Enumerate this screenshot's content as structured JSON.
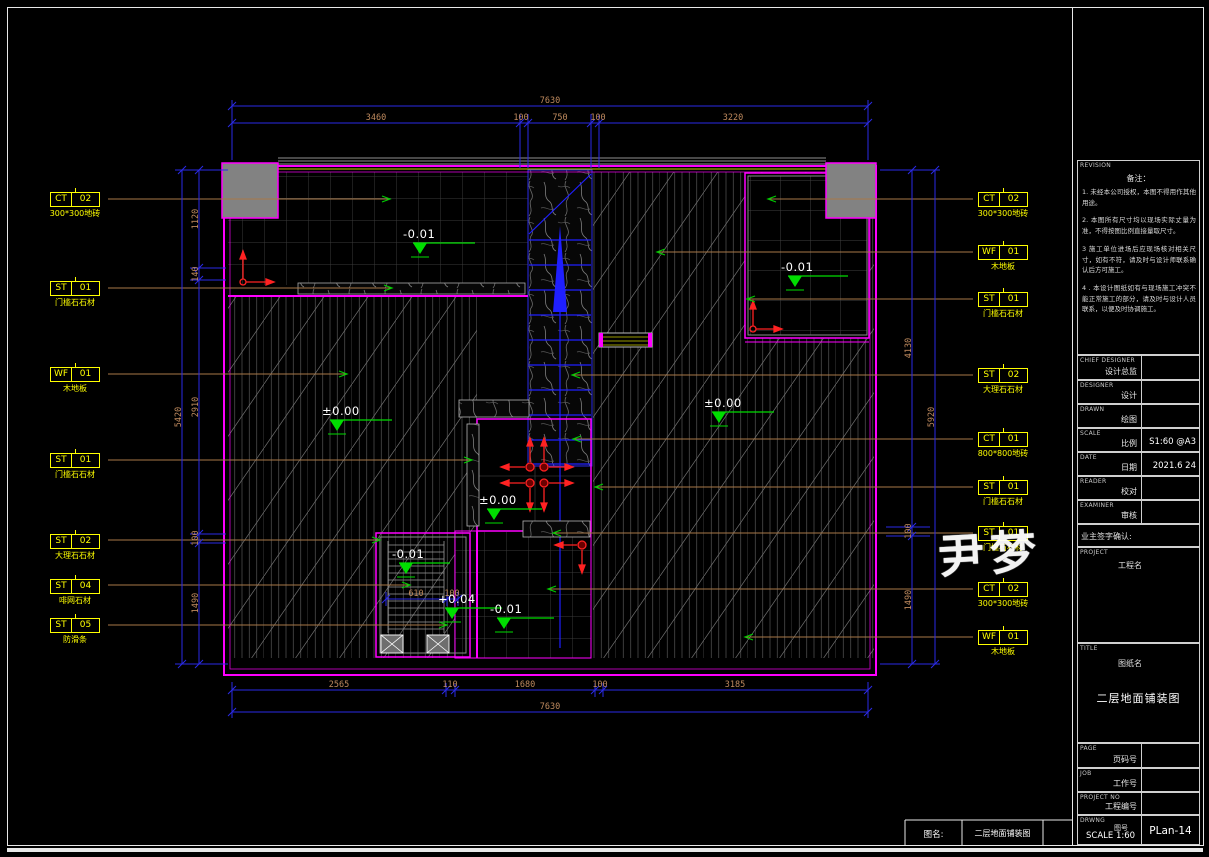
{
  "watermark": "尹梦",
  "bottom_bar": {
    "label": "图名:",
    "value": "二层地面铺装图"
  },
  "left_labels": [
    {
      "code": "CT",
      "num": "02",
      "desc": "300*300地砖"
    },
    {
      "code": "ST",
      "num": "01",
      "desc": "门槛石石材"
    },
    {
      "code": "WF",
      "num": "01",
      "desc": "木地板"
    },
    {
      "code": "ST",
      "num": "01",
      "desc": "门槛石石材"
    },
    {
      "code": "ST",
      "num": "02",
      "desc": "大理石石材"
    },
    {
      "code": "ST",
      "num": "04",
      "desc": "啡网石材"
    },
    {
      "code": "ST",
      "num": "05",
      "desc": "防滑条"
    }
  ],
  "right_labels": [
    {
      "code": "CT",
      "num": "02",
      "desc": "300*300地砖"
    },
    {
      "code": "WF",
      "num": "01",
      "desc": "木地板"
    },
    {
      "code": "ST",
      "num": "01",
      "desc": "门槛石石材"
    },
    {
      "code": "ST",
      "num": "02",
      "desc": "大理石石材"
    },
    {
      "code": "CT",
      "num": "01",
      "desc": "800*800地砖"
    },
    {
      "code": "ST",
      "num": "01",
      "desc": "门槛石石材"
    },
    {
      "code": "ST",
      "num": "01",
      "desc": "门槛石石材"
    },
    {
      "code": "CT",
      "num": "02",
      "desc": "300*300地砖"
    },
    {
      "code": "WF",
      "num": "01",
      "desc": "木地板"
    }
  ],
  "dims": {
    "top": {
      "overall": "7630",
      "segs": [
        "3460",
        "100",
        "750",
        "100",
        "3220"
      ]
    },
    "bottom": {
      "overall": "7630",
      "segs": [
        "2565",
        "110",
        "1680",
        "100",
        "3185"
      ]
    },
    "left": {
      "overall": "5420",
      "segs": [
        "1120",
        "140",
        "2910",
        "100",
        "1490"
      ]
    },
    "right": {
      "overall": "5920",
      "segs": [
        "4130",
        "100",
        "1490"
      ]
    },
    "stair": {
      "w": "610",
      "g": "100"
    }
  },
  "levels": {
    "tl": "-0.01",
    "tr": "-0.01",
    "left_room": "±0.00",
    "right_room": "±0.00",
    "lobby": "±0.00",
    "stair_top": "-0.01",
    "stair_mid": "+0.04",
    "stair_low": "-0.01"
  },
  "titleblock": {
    "revision_label": "REVISION",
    "notes_title": "备注：",
    "notes": [
      "1. 未经本公司授权，本图不得用作其他用途。",
      "2. 本图所有尺寸均以现场实际丈量为准，不得按图比例直接量取尺寸。",
      "3  施工单位进场后应现场核对相关尺寸，如有不符，请及时与设计师联系确认后方可施工。",
      "4 . 本设计图纸如有与现场施工冲突不能正常施工的部分，请及时与设计人员联系，以便及时协调施工。"
    ],
    "rows": [
      {
        "en": "CHIEF DESIGNER",
        "cn": "设计总监",
        "value": ""
      },
      {
        "en": "DESIGNER",
        "cn": "设计",
        "value": ""
      },
      {
        "en": "DRAWN",
        "cn": "绘图",
        "value": ""
      },
      {
        "en": "SCALE",
        "cn": "比例",
        "value": "S1:60 @A3"
      },
      {
        "en": "DATE",
        "cn": "日期",
        "value": "2021.6 24"
      },
      {
        "en": "READER",
        "cn": "校对",
        "value": ""
      },
      {
        "en": "EXAMINER",
        "cn": "审核",
        "value": ""
      }
    ],
    "sign_label": "业主签字确认:",
    "project_en": "PROJECT",
    "project_cn": "工程名",
    "title_en": "TITLE",
    "title_cn": "图纸名",
    "drawing_title": "二层地面铺装图",
    "page_en": "PAGE",
    "page_cn": "页码号",
    "job_en": "JOB",
    "job_cn": "工作号",
    "projno_en": "PROJECT  NO",
    "projno_cn": "工程编号",
    "drwng_en": "DRWNG",
    "drwng_cn": "图号",
    "drwng_scale": "SCALE 1:60",
    "drawing_no": "PLan-14"
  }
}
